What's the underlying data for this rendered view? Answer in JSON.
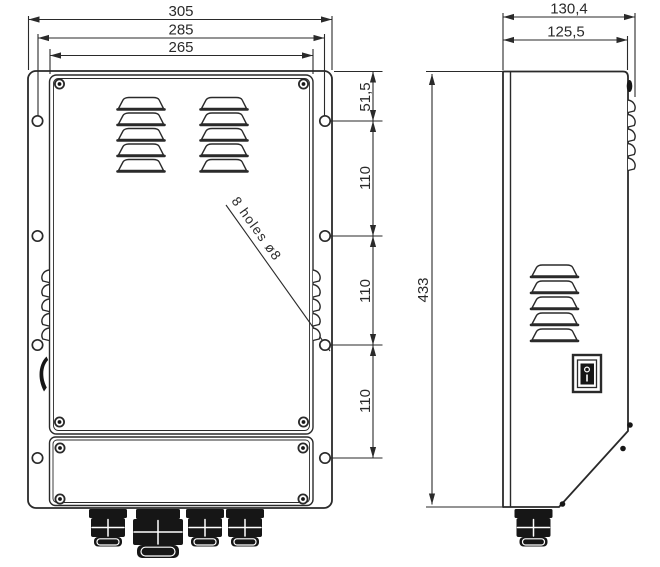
{
  "page": {
    "background": "#ffffff"
  },
  "drawing": {
    "kind": "technical dimensional drawing of a wall-mount enclosure (front view and side view)",
    "line_color": "#2a2a2a",
    "hardware_color": "#161616",
    "front_view": {
      "width_dims": [
        "305",
        "285",
        "265"
      ],
      "height_chain_dims": [
        "51,5",
        "110",
        "110",
        "110"
      ],
      "holes_note": "8 holes ø8"
    },
    "side_view": {
      "depth_dims": [
        "130,4",
        "125,5"
      ],
      "height_dim": "433"
    }
  }
}
